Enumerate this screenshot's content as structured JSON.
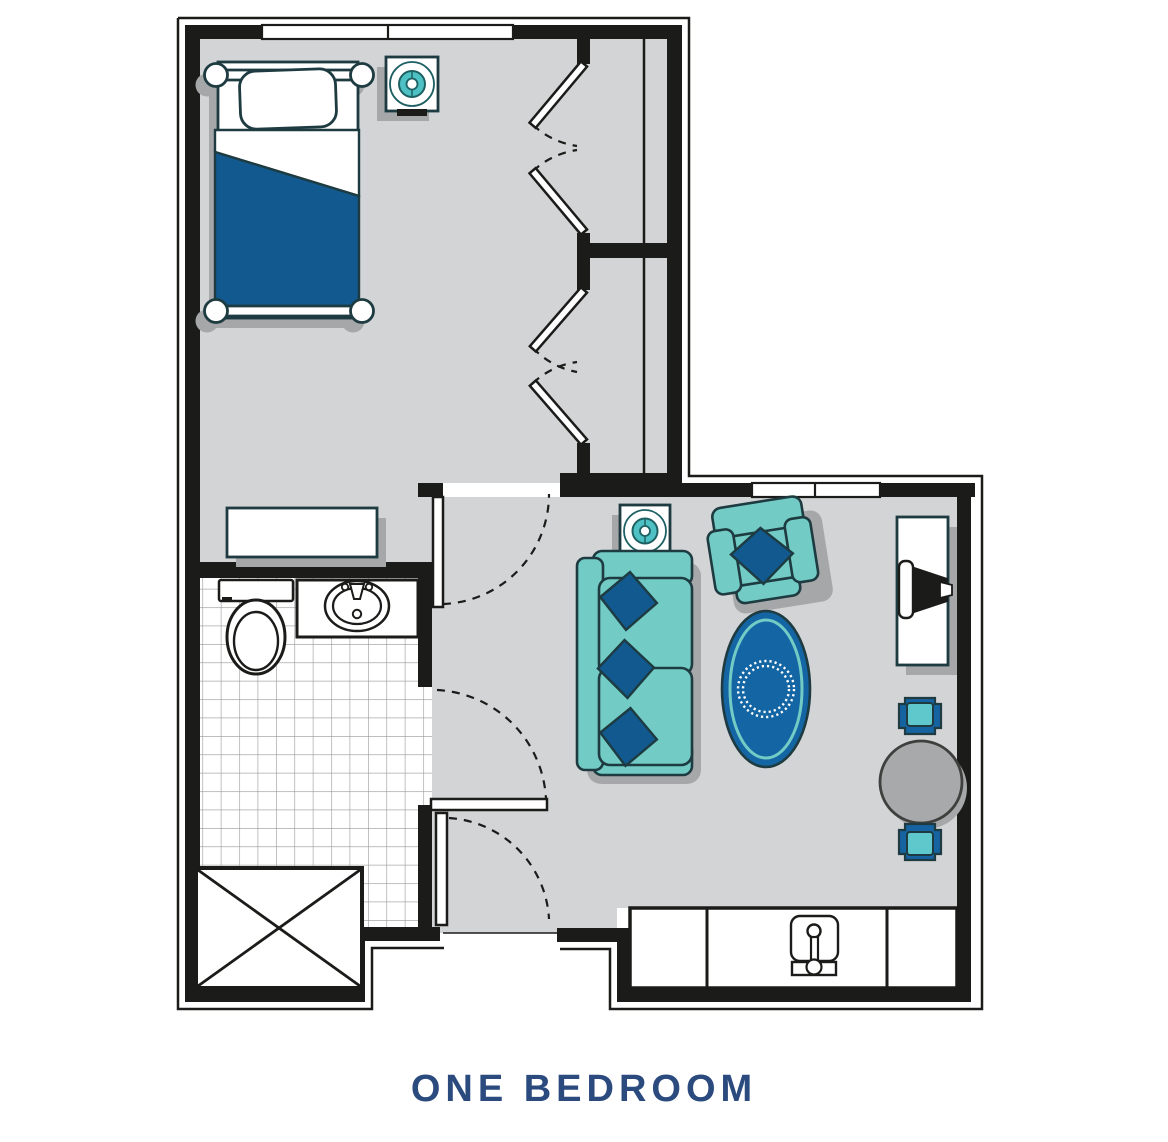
{
  "title": {
    "label": "ONE BEDROOM"
  },
  "colors": {
    "wall": "#1b1b19",
    "floor": "#d3d4d6",
    "tile": "#97989a",
    "outline": "#1d3b40",
    "teal": "#72cbc5",
    "blue": "#11598f",
    "rugblue": "#1465a3",
    "lampteal": "#4ec1c5",
    "lampring": "#1e6164",
    "chairblue": "#1563a0",
    "chairteal": "#5fc8cc",
    "tablegray": "#a8a9ab",
    "shadow": "#a6a7a9",
    "navy": "#2b4a7e"
  },
  "icons": {
    "bed": "bed-icon",
    "lamp_table": "side-table-lamp-icon",
    "dresser": "dresser-icon",
    "toilet": "toilet-icon",
    "sink": "sink-icon",
    "shower": "shower-icon",
    "sofa": "sofa-icon",
    "armchair": "armchair-icon",
    "rug": "area-rug-icon",
    "desk": "desk-icon",
    "desk_chair": "desk-chair-icon",
    "dining_table": "round-table-icon",
    "dining_chair": "dining-chair-icon",
    "kitchen_sink": "kitchenette-sink-icon"
  }
}
